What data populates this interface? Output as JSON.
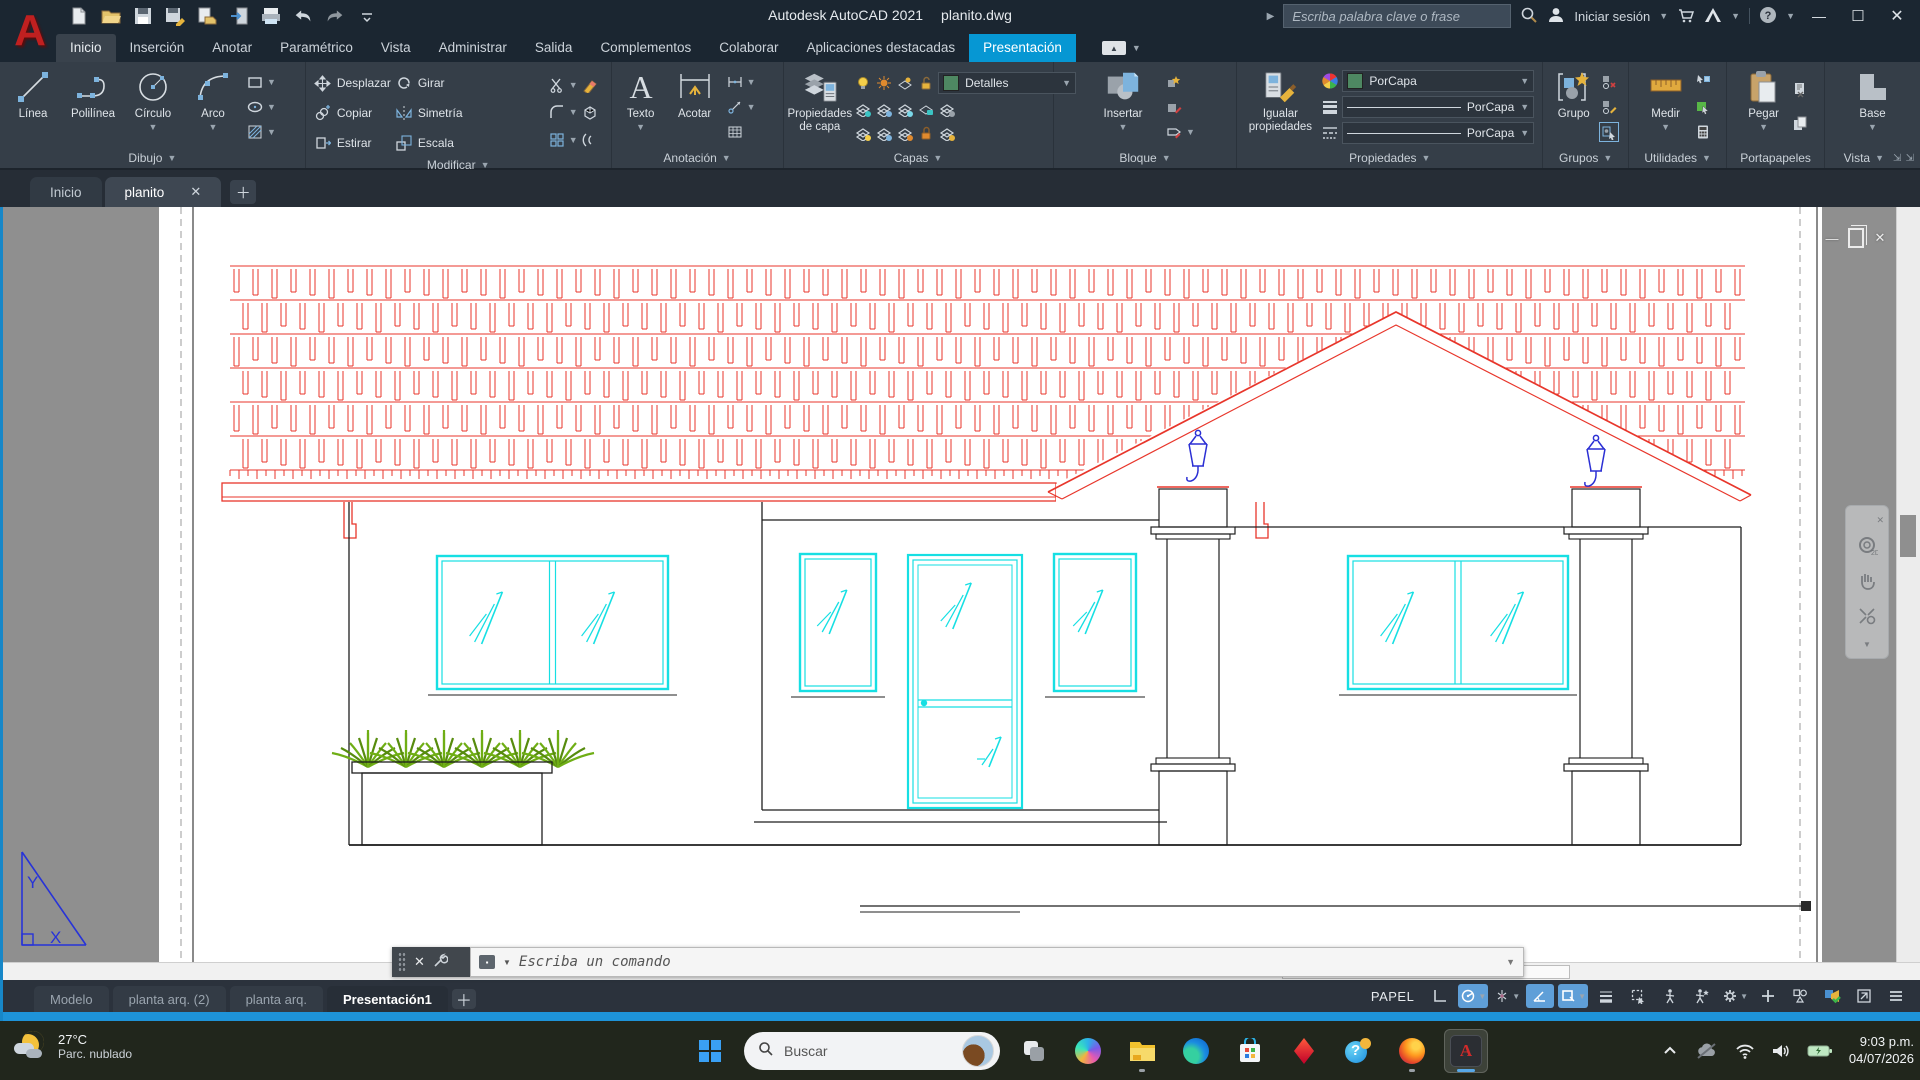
{
  "titlebar": {
    "app_title": "Autodesk AutoCAD 2021",
    "doc_title": "planito.dwg",
    "search_placeholder": "Escriba palabra clave o frase",
    "sign_in_label": "Iniciar sesión",
    "qat_icons": [
      "new-file",
      "open-folder",
      "save",
      "save-as",
      "open-from-web",
      "transfer",
      "plot",
      "undo",
      "redo",
      "qat-menu"
    ]
  },
  "ribbon": {
    "tabs": [
      {
        "label": "Inicio",
        "state": "current"
      },
      {
        "label": "Inserción",
        "state": ""
      },
      {
        "label": "Anotar",
        "state": ""
      },
      {
        "label": "Paramétrico",
        "state": ""
      },
      {
        "label": "Vista",
        "state": ""
      },
      {
        "label": "Administrar",
        "state": ""
      },
      {
        "label": "Salida",
        "state": ""
      },
      {
        "label": "Complementos",
        "state": ""
      },
      {
        "label": "Colaborar",
        "state": ""
      },
      {
        "label": "Aplicaciones destacadas",
        "state": ""
      },
      {
        "label": "Presentación",
        "state": "selected"
      }
    ],
    "panels": {
      "dibujo": {
        "title": "Dibujo",
        "linea": "Línea",
        "polilinea": "Polilínea",
        "circulo": "Círculo",
        "arco": "Arco"
      },
      "modificar": {
        "title": "Modificar",
        "desplazar": "Desplazar",
        "girar": "Girar",
        "copiar": "Copiar",
        "simetria": "Simetría",
        "estirar": "Estirar",
        "escala": "Escala"
      },
      "anotacion": {
        "title": "Anotación",
        "texto": "Texto",
        "acotar": "Acotar"
      },
      "capas": {
        "title": "Capas",
        "propiedades_de_capa": "Propiedades de capa",
        "current_layer": "Detalles",
        "layer_swatch_color": "#4e8862"
      },
      "bloque": {
        "title": "Bloque",
        "insertar": "Insertar"
      },
      "propiedades": {
        "title": "Propiedades",
        "igualar": "Igualar propiedades",
        "color_value": "PorCapa",
        "lineweight_value": "PorCapa",
        "linetype_value": "PorCapa"
      },
      "grupos": {
        "title": "Grupos",
        "grupo": "Grupo"
      },
      "utilidades": {
        "title": "Utilidades",
        "medir": "Medir"
      },
      "portapapeles": {
        "title": "Portapapeles",
        "pegar": "Pegar"
      },
      "vista": {
        "title": "Vista",
        "base": "Base"
      }
    }
  },
  "file_tabs": {
    "inicio": "Inicio",
    "planito": "planito"
  },
  "command_line": {
    "placeholder": "Escriba un comando"
  },
  "layout_tabs": [
    {
      "label": "Modelo",
      "active": false
    },
    {
      "label": "planta arq. (2)",
      "active": false
    },
    {
      "label": "planta arq.",
      "active": false
    },
    {
      "label": "Presentación1",
      "active": true
    }
  ],
  "status_bar": {
    "space_label": "PAPEL",
    "toggles": [
      {
        "name": "grid-display",
        "active": false,
        "caret": false
      },
      {
        "name": "snap-cursor",
        "active": true,
        "caret": true
      },
      {
        "name": "osnap-tracking",
        "active": false,
        "caret": true
      },
      {
        "name": "dynamic-input",
        "active": true,
        "caret": false
      },
      {
        "name": "object-snap",
        "active": true,
        "caret": true
      },
      {
        "name": "lineweight-display",
        "active": false,
        "caret": false
      },
      {
        "name": "selection-cycling",
        "active": false,
        "caret": false
      },
      {
        "name": "annotation-visibility",
        "active": false,
        "caret": false
      },
      {
        "name": "annotation-autoscale",
        "active": false,
        "caret": false
      },
      {
        "name": "workspace-gear",
        "active": false,
        "caret": true
      },
      {
        "name": "crosshair-plus",
        "active": false,
        "caret": false
      },
      {
        "name": "isolate-objects",
        "active": false,
        "caret": false
      },
      {
        "name": "graphics-performance",
        "active": false,
        "caret": false
      },
      {
        "name": "clean-screen",
        "active": false,
        "caret": false
      },
      {
        "name": "customization-menu",
        "active": false,
        "caret": false
      }
    ]
  },
  "taskbar": {
    "weather": {
      "temp": "27°C",
      "condition": "Parc. nublado"
    },
    "search_label": "Buscar",
    "apps": [
      {
        "name": "task-view",
        "running": false,
        "active": false
      },
      {
        "name": "copilot",
        "running": false,
        "active": false
      },
      {
        "name": "file-explorer",
        "running": true,
        "active": false
      },
      {
        "name": "edge",
        "running": false,
        "active": false
      },
      {
        "name": "store",
        "running": false,
        "active": false
      },
      {
        "name": "autodesk-access",
        "running": false,
        "active": false
      },
      {
        "name": "help-app",
        "running": false,
        "active": false
      },
      {
        "name": "firefox",
        "running": true,
        "active": false
      },
      {
        "name": "autocad",
        "running": true,
        "active": true
      }
    ],
    "tray_icons": [
      "tray-chevron",
      "onedrive-paused",
      "wifi",
      "volume",
      "battery-charging"
    ],
    "clock": {
      "time": "9:03 p.m.",
      "date": "04/07/2026"
    }
  },
  "drawing": {
    "colors": {
      "paper": "#ffffff",
      "canvas": "#8f8f8f",
      "roof": "#e8362b",
      "walls": "#1f1f1f",
      "windows": "#16dfe3",
      "plants": "#6fae15",
      "plants_dark": "#578c0e",
      "lamps": "#2b2fd4",
      "ucs": "#2733d8"
    },
    "ucs": {
      "x_label": "X",
      "y_label": "Y"
    },
    "navigation_bar": {
      "wheel_label": "2D"
    }
  }
}
